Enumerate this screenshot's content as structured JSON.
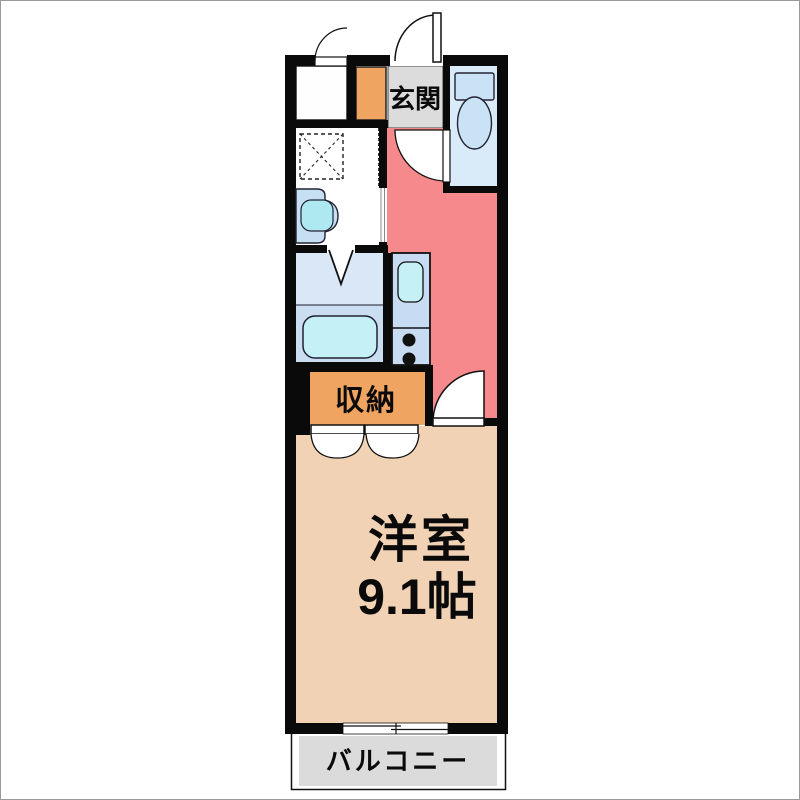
{
  "floorplan": {
    "rooms": {
      "entrance": {
        "label": "玄関"
      },
      "closet": {
        "label": "収納"
      },
      "western_room": {
        "label": "洋室",
        "size": "9.1帖"
      },
      "balcony": {
        "label": "バルコニー"
      }
    },
    "palette": {
      "wall": "#0a0a0a",
      "hallway_kitchen_floor": "#F5898B",
      "western_room_floor": "#F2D2B4",
      "closet_fill": "#F0A461",
      "shoe_cabinet_fill": "#F0A461",
      "entrance_floor": "#DCDCDC",
      "balcony_floor": "#DBDBDB",
      "toilet_floor": "#D9EAF9",
      "bathroom_floor_upper": "#D9E7F6",
      "bathroom_floor_lower": "#CBDDF1",
      "bathtub_fill": "#C4F0F6",
      "kitchen_counter_fill": "#C7DCF2",
      "kitchen_sink_fill": "#C4F0F6",
      "washbasin_fill": "#C7DFF2",
      "washbasin_bowl_fill": "#AEE8F0",
      "toilet_fixture_fill": "#C9E2F6"
    }
  }
}
